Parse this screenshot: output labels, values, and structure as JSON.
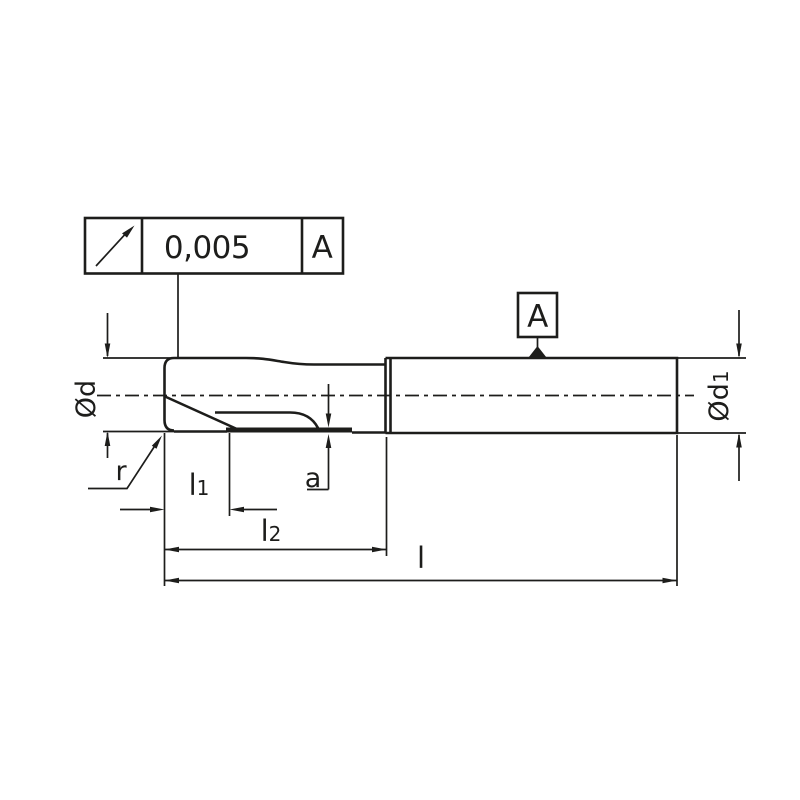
{
  "colors": {
    "ink": "#1d1d1b",
    "background": "#ffffff"
  },
  "tolerance_frame": {
    "symbol": "circular-runout-arrow",
    "value": "0,005",
    "datum_ref": "A"
  },
  "datum_flag": {
    "label": "A"
  },
  "labels": {
    "diameter_cut": "Ød",
    "diameter_shank_base": "Ød",
    "diameter_shank_sub": "1",
    "radius": "r",
    "flute_length_base": "l",
    "flute_length_sub": "1",
    "cut_length_base": "l",
    "cut_length_sub": "2",
    "overall_length": "l",
    "edge_offset": "a"
  }
}
